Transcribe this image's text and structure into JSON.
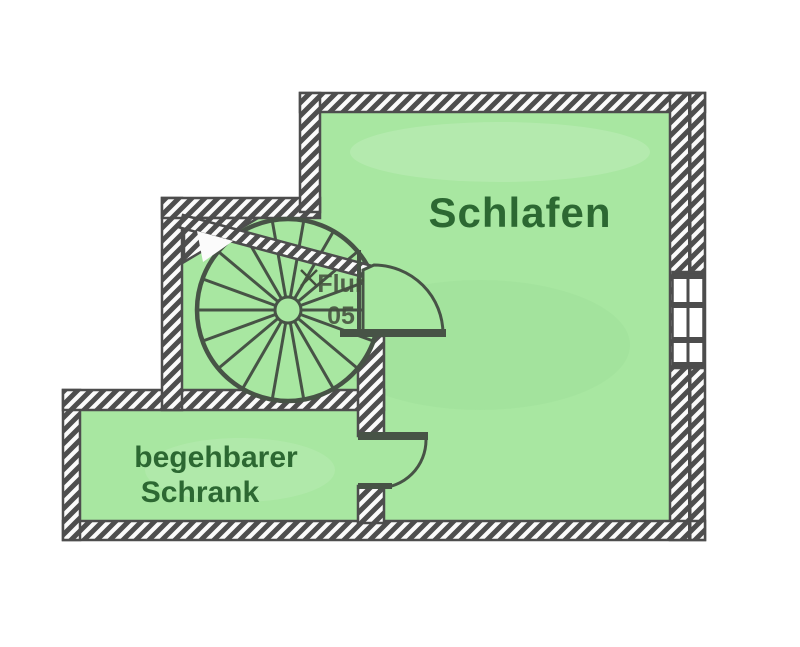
{
  "plan": {
    "labels": {
      "bedroom": "Schlafen",
      "closet_line1": "begehbarer",
      "closet_line2": "Schrank",
      "hall": "Flur",
      "hall_number": "05"
    }
  },
  "colors": {
    "background": "#ffffff",
    "room_fill": "#a8e7a1",
    "room_fill_shade": "#8fd98f",
    "label_green": "#2c6832",
    "scan_ink": "#44503e",
    "stair_line": "#475346",
    "wall_gray": "#4e4e4e",
    "wall_line": "#4d4d4d",
    "wall_bg": "#fbfbfb"
  }
}
